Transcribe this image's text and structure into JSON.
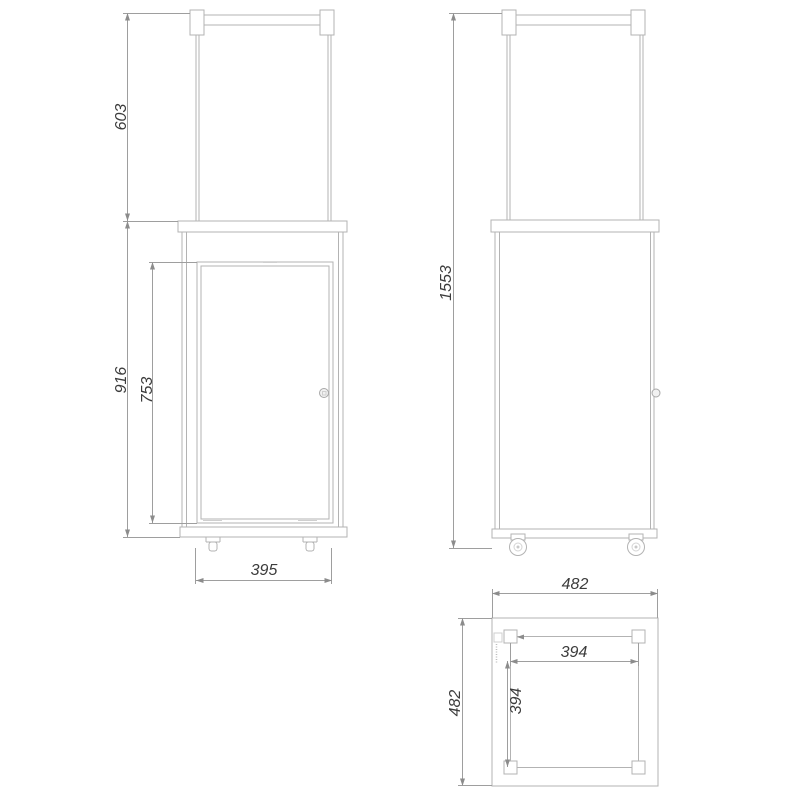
{
  "drawing": {
    "type": "technical drawing",
    "subject": "patio gas heater - front view, side view and top view",
    "units": "mm",
    "colors": {
      "background": "#ffffff",
      "object_line": "#b3b3b3",
      "dimension_line": "#9e9e9e",
      "dimension_text": "#3c3c3c"
    },
    "views": {
      "front": {
        "dims": {
          "upper_frame_height": "603",
          "body_height": "916",
          "door_height": "753",
          "door_width": "395"
        }
      },
      "side": {
        "dims": {
          "overall_height": "1553"
        }
      },
      "top": {
        "dims": {
          "overall_width": "482",
          "overall_depth": "482",
          "inner_frame_width": "394",
          "inner_frame_depth": "394"
        }
      }
    }
  }
}
